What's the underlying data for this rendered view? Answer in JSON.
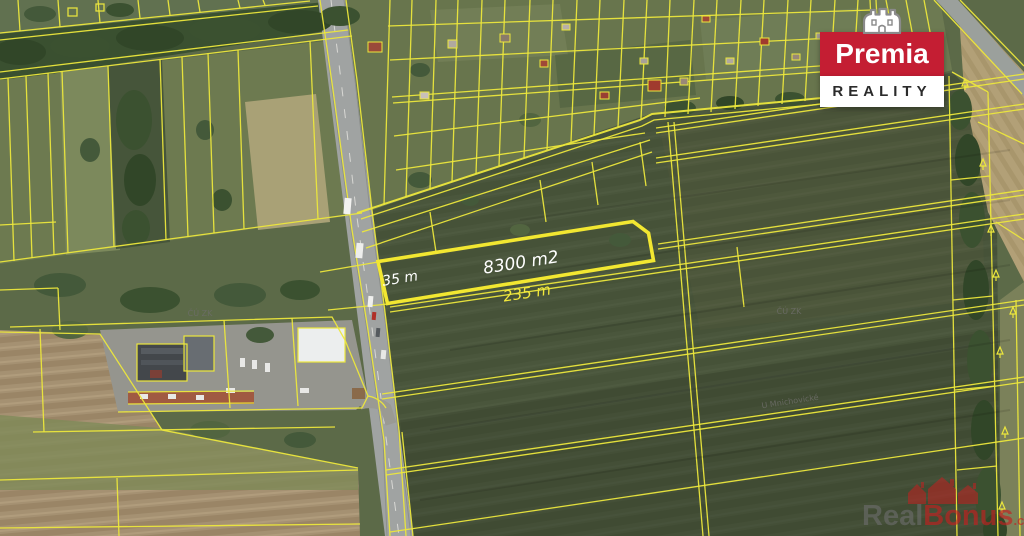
{
  "branding": {
    "name": "Premia",
    "subtitle": "REALITY",
    "primary_color": "#c41e33",
    "crown_icon": "crown-icon"
  },
  "parcel": {
    "area": "8300 m2",
    "width": "35 m",
    "length": "235 m",
    "fill_color": "#1a76bc",
    "outline_color": "#f2e731"
  },
  "labels": {
    "cadastre_left": "ČÚ ZK",
    "cadastre_right": "ČÚ ZK",
    "street": "U Mnichovické"
  },
  "watermark": {
    "prefix": "Real",
    "brand": "Bonus",
    "domain": ".cz",
    "houses_icon": "houses-watermark-icon",
    "gray_color": "#6e6e6e",
    "red_color": "#c32020"
  },
  "map": {
    "cadastral_line_color": "#ece73c",
    "type": "aerial-cadastral-map"
  }
}
